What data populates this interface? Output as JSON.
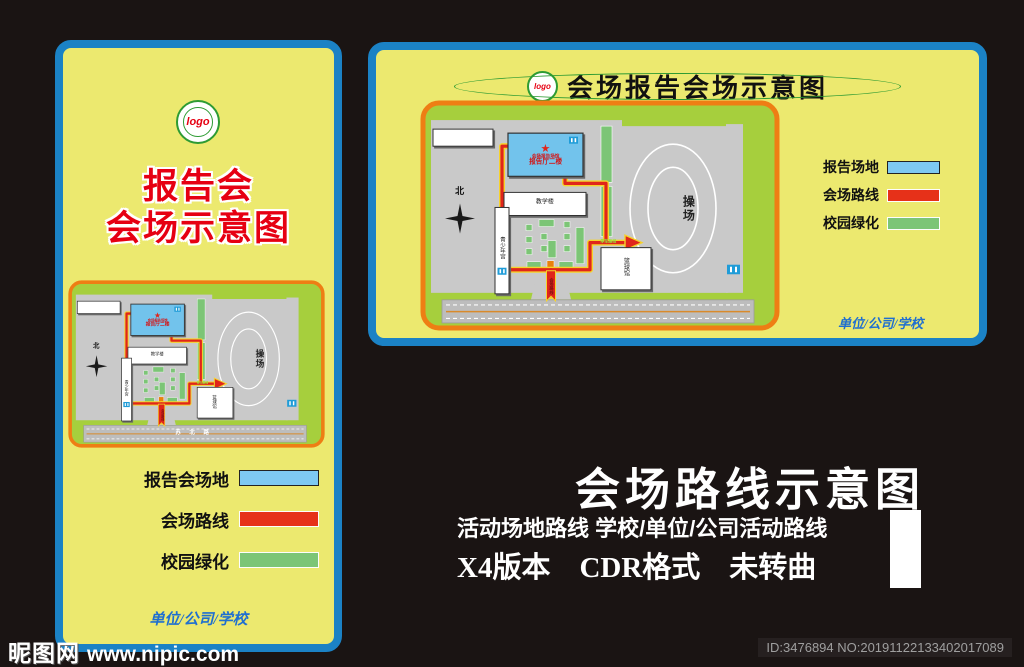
{
  "colors": {
    "panel_border_blue": "#1b82c5",
    "panel_yellow": "#ece96f",
    "campus_green": "#a6cf3d",
    "map_border_orange": "#ee7e14",
    "legend_blue": "#7ec9f2",
    "legend_red": "#e63119",
    "legend_green": "#7cc576",
    "route_red": "#e0251b",
    "route_casing_yellow": "#f6d32b",
    "title_red": "#e60012",
    "script_blue": "#1f6fd0"
  },
  "icons": {
    "star": "★"
  },
  "left_panel": {
    "logo_text": "logo",
    "title_line1": "报告会",
    "title_line2": "会场示意图",
    "legend": {
      "venue": {
        "label": "报告会场地"
      },
      "route": {
        "label": "会场路线"
      },
      "greenery": {
        "label": "校园绿化"
      }
    },
    "signature": "单位/公司/学校"
  },
  "right_panel": {
    "logo_text": "logo",
    "title": "会场报告会场示意图",
    "legend": {
      "venue": {
        "label": "报告场地"
      },
      "route": {
        "label": "会场路线"
      },
      "greenery": {
        "label": "校园绿化"
      }
    },
    "signature": "单位/公司/学校"
  },
  "map": {
    "north": "北",
    "hall_line1": "会场报告场馆",
    "hall_line2": "报告厅二楼",
    "teaching_building": "教学楼",
    "youth_palace": "青少年宫",
    "basketball_hall": "篮球馆",
    "playground": "操场",
    "parking_route": "停车路线",
    "venue_route": "会场路线",
    "road_name": "苏 北 路"
  },
  "promo": {
    "headline": "会场路线示意图",
    "subline": "活动场地路线 学校/单位/公司活动路线",
    "spec_line": "X4版本　CDR格式　未转曲"
  },
  "watermark": {
    "site_name": "昵图网",
    "site_url": "www.nipic.com",
    "image_id": "ID:3476894 NO:20191122133402017089"
  }
}
